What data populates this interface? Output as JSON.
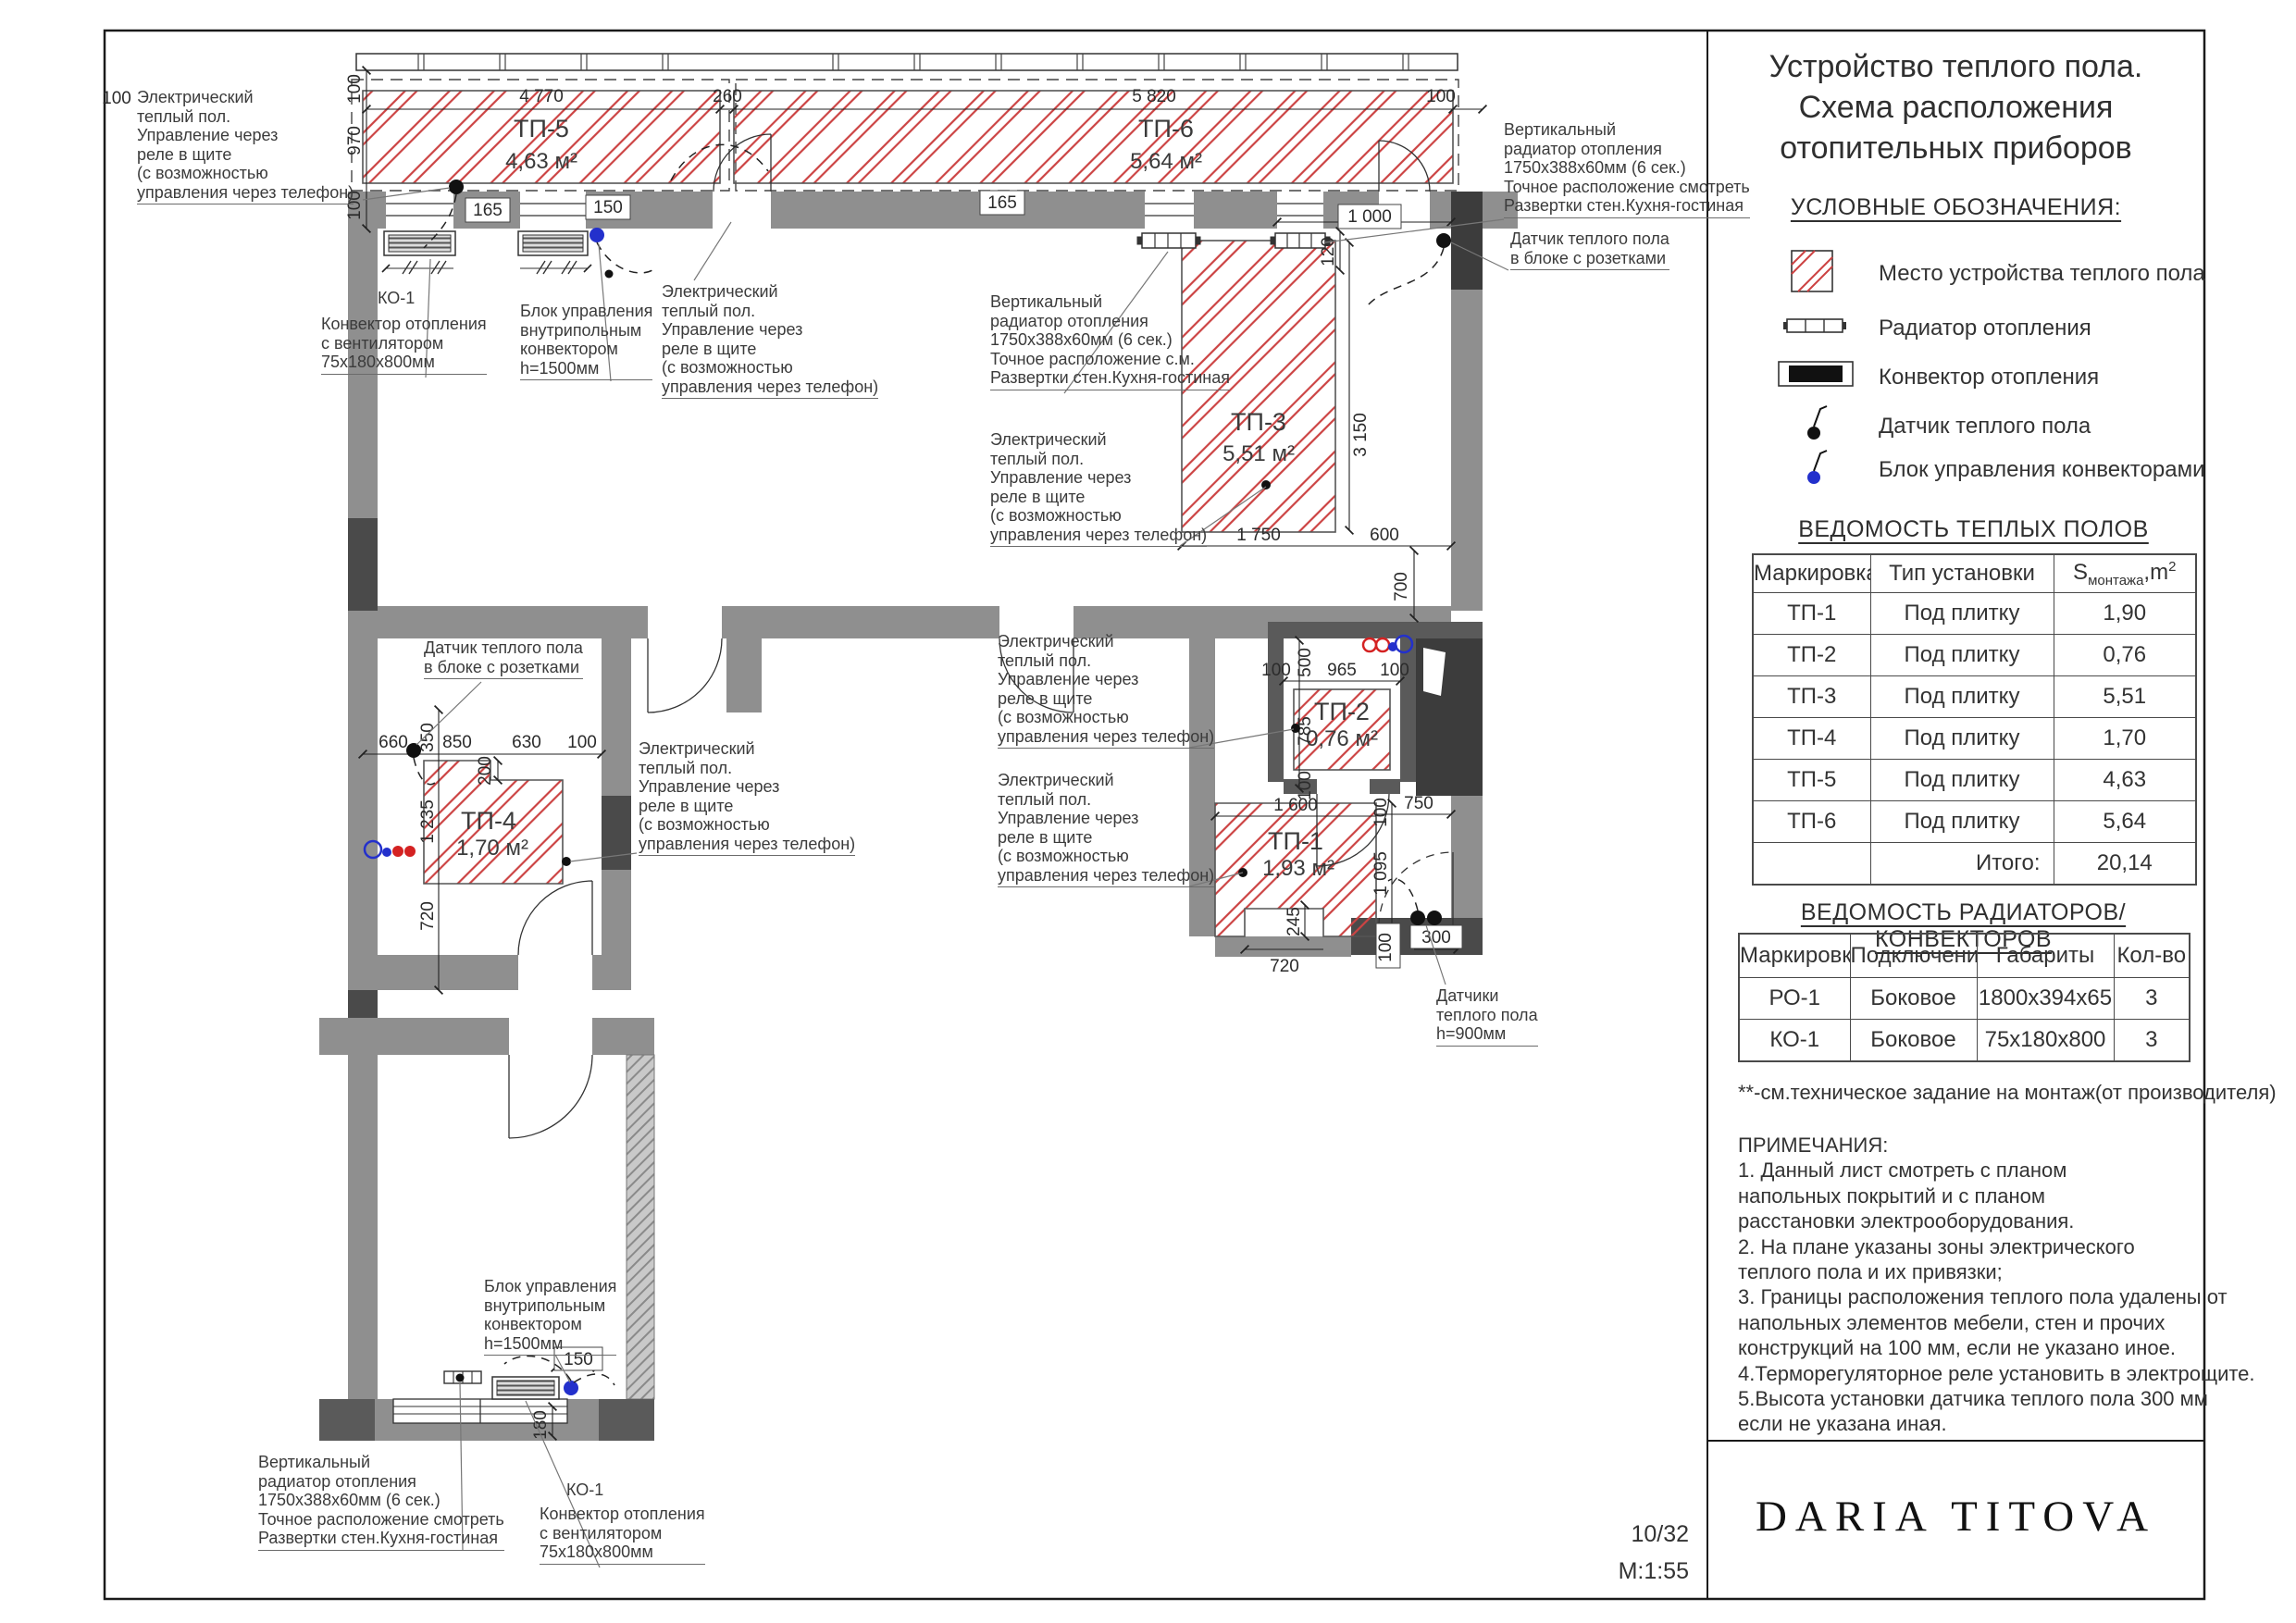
{
  "sheet": {
    "number": "10/32",
    "scale": "М:1:55",
    "logo": "DARIA TITOVA"
  },
  "title": "Устройство теплого пола.\nСхема расположения\nотопительных приборов",
  "legend": {
    "heading": "УСЛОВНЫЕ ОБОЗНАЧЕНИЯ:",
    "items": [
      {
        "icon": "warm-floor-hatch",
        "label": "Место устройства теплого пола"
      },
      {
        "icon": "radiator",
        "label": "Радиатор отопления"
      },
      {
        "icon": "convector",
        "label": "Конвектор отопления"
      },
      {
        "icon": "floor-sensor",
        "label": "Датчик теплого пола"
      },
      {
        "icon": "convector-control-unit",
        "label": "Блок управления конвекторами"
      }
    ]
  },
  "warm_floor_table": {
    "heading": "ВЕДОМОСТЬ ТЕПЛЫХ ПОЛОВ",
    "columns": {
      "marking": "Маркировка",
      "install_type": "Тип установки",
      "area_s": "S",
      "area_sub": "монтажа",
      "area_unit": ",m",
      "area_sup": "2"
    },
    "rows": [
      {
        "marking": "ТП-1",
        "type": "Под плитку",
        "area": "1,90"
      },
      {
        "marking": "ТП-2",
        "type": "Под плитку",
        "area": "0,76"
      },
      {
        "marking": "ТП-3",
        "type": "Под плитку",
        "area": "5,51"
      },
      {
        "marking": "ТП-4",
        "type": "Под плитку",
        "area": "1,70"
      },
      {
        "marking": "ТП-5",
        "type": "Под плитку",
        "area": "4,63"
      },
      {
        "marking": "ТП-6",
        "type": "Под плитку",
        "area": "5,64"
      }
    ],
    "total_label": "Итого:",
    "total_value": "20,14"
  },
  "radiator_table": {
    "heading": "ВЕДОМОСТЬ РАДИАТОРОВ/КОНВЕКТОРОВ",
    "columns": {
      "marking": "Маркировка",
      "connection": "Подключение",
      "dimensions": "Габариты",
      "qty": "Кол-во"
    },
    "rows": [
      {
        "marking": "РО-1",
        "connection": "Боковое",
        "dimensions": "1800х394х65",
        "qty": "3"
      },
      {
        "marking": "КО-1",
        "connection": "Боковое",
        "dimensions": "75х180х800",
        "qty": "3"
      }
    ]
  },
  "footnote": "**-см.техническое задание на монтаж(от производителя)",
  "notes": "ПРИМЕЧАНИЯ:\n1. Данный лист смотреть с планом\nнапольных покрытий и с планом\nрасстановки электрооборудования.\n2. На плане указаны зоны электрического\nтеплого пола и их привязки;\n3. Границы расположения теплого пола удалены от\nнапольных элементов мебели, стен и прочих\nконструкций на 100 мм, если не указано иное.\n4.Терморегуляторное реле установить в электрощите.\n5.Высота установки датчика теплого пола 300 мм\nесли не указана иная.",
  "plan": {
    "zones": [
      {
        "id": "ТП-5",
        "area": "4,63 м²"
      },
      {
        "id": "ТП-6",
        "area": "5,64 м²"
      },
      {
        "id": "ТП-3",
        "area": "5,51 м²"
      },
      {
        "id": "ТП-2",
        "area": "0,76 м²"
      },
      {
        "id": "ТП-1",
        "area": "1,93 м²"
      },
      {
        "id": "ТП-4",
        "area": "1,70 м²"
      }
    ],
    "labels": {
      "electric_floor": "Электрический\nтеплый пол.\nУправление через\nреле в щите\n(с возможностью\nуправления через телефон)",
      "ko1": "КО-1",
      "convector_fan": "Конвектор отопления\nс вентилятором\n75х180х800мм",
      "control_unit": "Блок управления\nвнутрипольным\nконвектором\nh=1500мм",
      "vert_radiator_sm": "Вертикальный\nрадиатор отопления\n1750х388х60мм (6 сек.)\nТочное расположение с.м.\nРазвертки стен.Кухня-гостиная",
      "vert_radiator": "Вертикальный\nрадиатор отопления\n1750х388х60мм (6 сек.)\nТочное расположение смотреть\nРазвертки стен.Кухня-гостиная",
      "sensor_sockets": "Датчик теплого пола\nв блоке с розетками",
      "sensors_h900": "Датчики\nтеплого пола\nh=900мм"
    },
    "dims": [
      "100",
      "100",
      "970",
      "100",
      "4 770",
      "260",
      "5 820",
      "100",
      "165",
      "150",
      "165",
      "1 000",
      "120",
      "3 150",
      "1 750",
      "600",
      "700",
      "100",
      "500",
      "965",
      "100",
      "785",
      "100",
      "1 600",
      "100",
      "750",
      "1 095",
      "245",
      "720",
      "100",
      "300",
      "660",
      "350",
      "850",
      "630",
      "100",
      "200",
      "1 235",
      "720",
      "150",
      "180"
    ]
  }
}
